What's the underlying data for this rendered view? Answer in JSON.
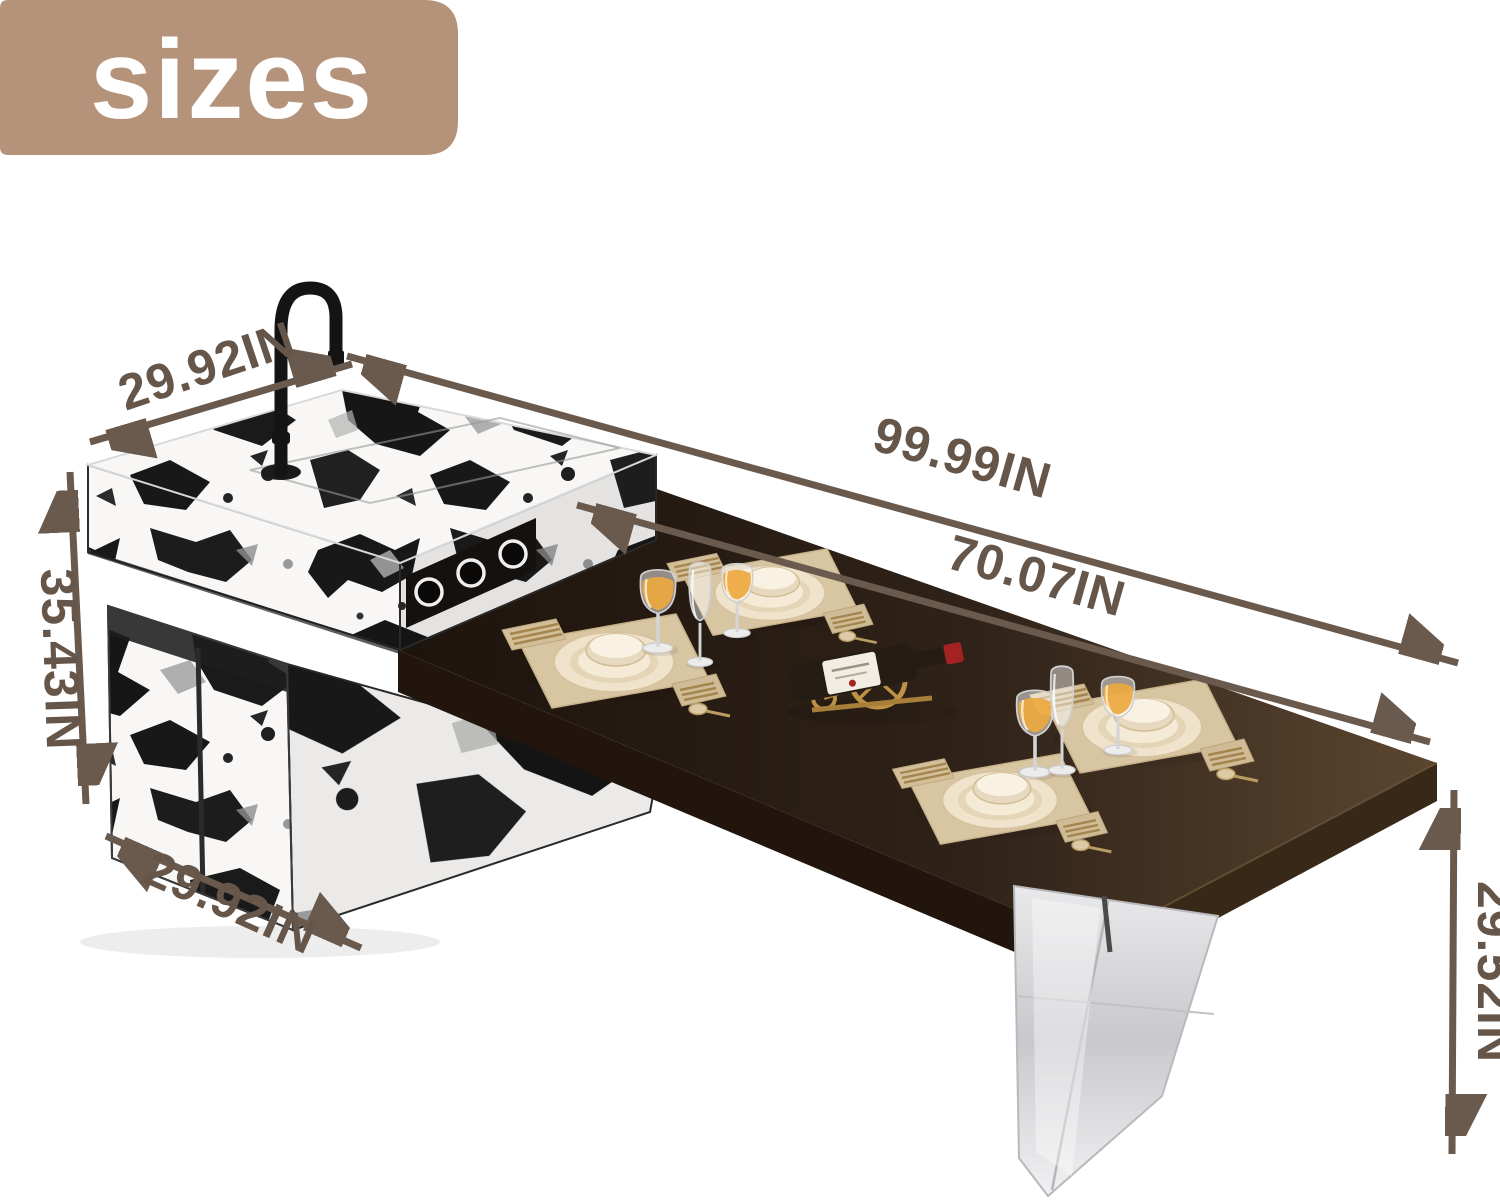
{
  "badge": {
    "label": "sizes"
  },
  "dimensions": [
    {
      "name": "countertop-width",
      "label": "29.92IN"
    },
    {
      "name": "overall-length",
      "label": "99.99IN"
    },
    {
      "name": "tabletop-length",
      "label": "70.07IN"
    },
    {
      "name": "island-height",
      "label": "35.43IN"
    },
    {
      "name": "cabinet-width",
      "label": "29.92IN"
    },
    {
      "name": "table-height",
      "label": "29.52IN"
    }
  ],
  "unit": "IN",
  "colors": {
    "badge_bg": "#b5937a",
    "badge_text": "#ffffff",
    "annotation": "#6a594d",
    "tabletop_dark": "#241812",
    "marble_base": "#f8f7f5",
    "marble_ink": "#181818",
    "acrylic_leg": "#d9d9dc",
    "placemat": "#d8c5a2",
    "dinnerware": "#efe3cc",
    "gold_accent": "#bb9147",
    "wine": "#eda83f",
    "faucet_black": "#141414",
    "wine_cap_red": "#a32222"
  }
}
